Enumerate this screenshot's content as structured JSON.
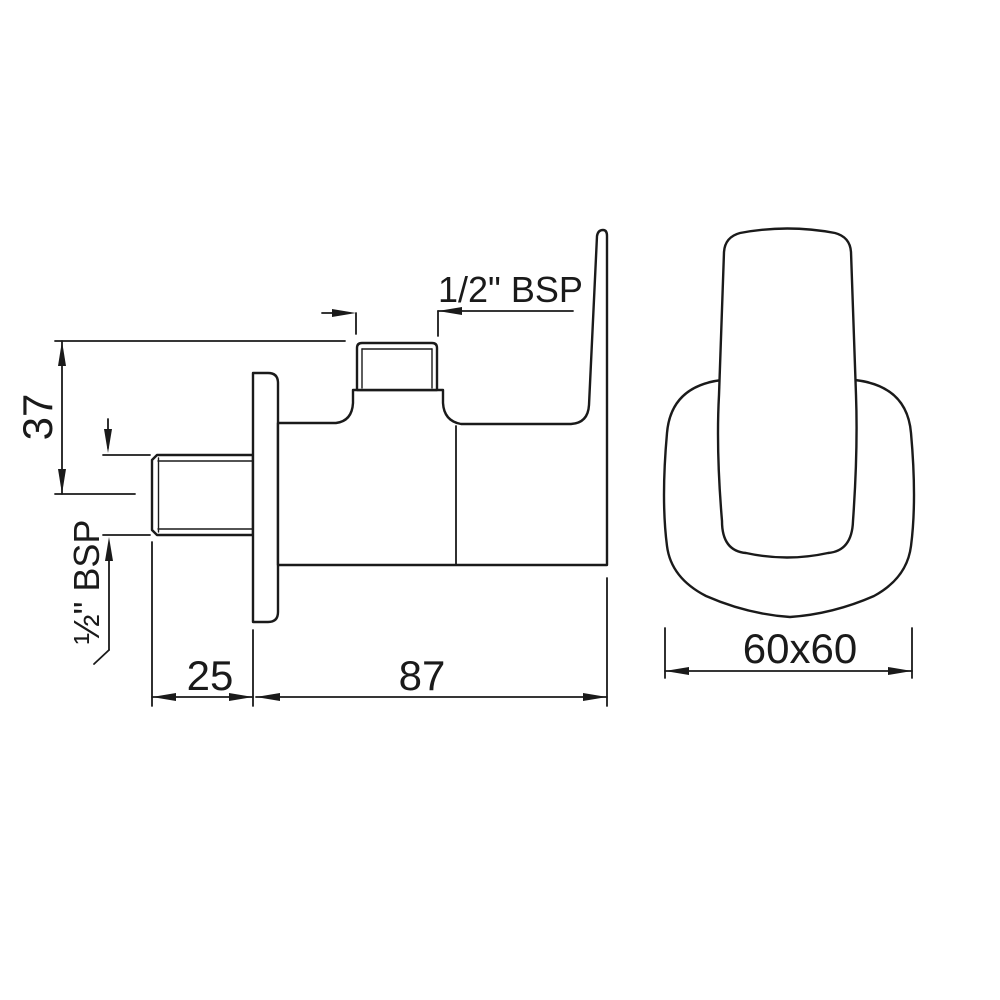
{
  "drawing": {
    "kind": "angle-valve dimension drawing",
    "side_view": {
      "labels": {
        "top_thread": "1/2\" BSP",
        "inlet_thread": "½\" BSP",
        "height": "37",
        "inlet_length": "25",
        "depth": "87"
      }
    },
    "front_view": {
      "labels": {
        "plate_size": "60x60"
      }
    },
    "colors": {
      "line": "#1a1a1a",
      "background": "#ffffff"
    }
  }
}
